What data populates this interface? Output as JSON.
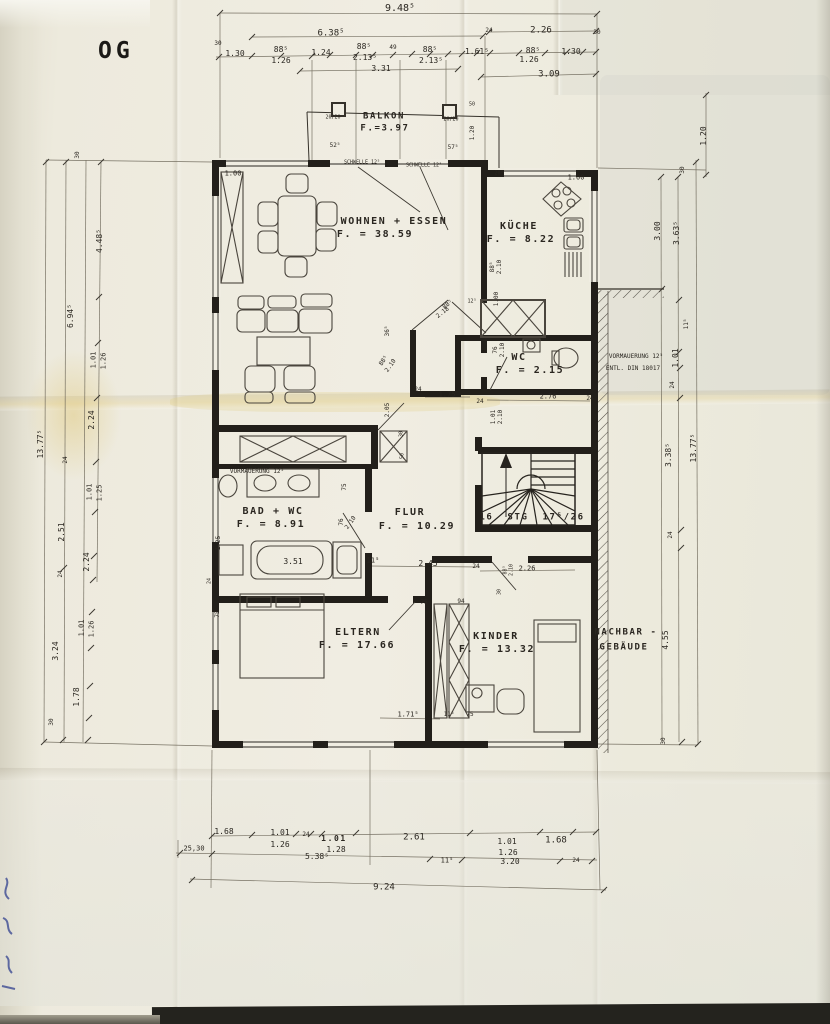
{
  "title": "OG",
  "document_type": "scanned architectural floor plan, upper storey (OG)",
  "colors": {
    "paper": "#efece1",
    "ink": "#26231d",
    "dimension_ink": "#6b6557",
    "handwriting_blue": "#32418f",
    "scan_band": "#24231e"
  },
  "rooms": [
    {
      "name": "BALKON",
      "area": "F.=3.97"
    },
    {
      "name": "WOHNEN + ESSEN",
      "area": "F. = 38.59"
    },
    {
      "name": "KÜCHE",
      "area": "F. = 8.22"
    },
    {
      "name": "WC",
      "area": "F. = 2.15"
    },
    {
      "name": "BAD + WC",
      "area": "F. = 8.91"
    },
    {
      "name": "FLUR",
      "area": "F. = 10.29"
    },
    {
      "name": "ELTERN",
      "area": "F. = 17.66"
    },
    {
      "name": "KINDER",
      "area": "F. = 13.32"
    }
  ],
  "labels": [
    {
      "t": "9.48⁵",
      "x": 400,
      "y": 9,
      "s": 10
    },
    {
      "t": "6.38⁵",
      "x": 331,
      "y": 34,
      "s": 9
    },
    {
      "t": "2.26",
      "x": 541,
      "y": 31,
      "s": 9
    },
    {
      "t": "24",
      "x": 489,
      "y": 31,
      "s": 6
    },
    {
      "t": "30",
      "x": 218,
      "y": 44,
      "s": 6
    },
    {
      "t": "30",
      "x": 597,
      "y": 33,
      "s": 6
    },
    {
      "t": "1.30",
      "x": 235,
      "y": 54,
      "s": 8
    },
    {
      "t": "88⁵",
      "x": 281,
      "y": 50,
      "s": 8
    },
    {
      "t": "1.26",
      "x": 281,
      "y": 61,
      "s": 8
    },
    {
      "t": "1.24",
      "x": 321,
      "y": 53,
      "s": 8
    },
    {
      "t": "88⁵",
      "x": 364,
      "y": 47,
      "s": 8
    },
    {
      "t": "2.13⁵",
      "x": 365,
      "y": 58,
      "s": 8
    },
    {
      "t": "49",
      "x": 393,
      "y": 48,
      "s": 6
    },
    {
      "t": "88⁵",
      "x": 430,
      "y": 50,
      "s": 8
    },
    {
      "t": "2.13⁵",
      "x": 431,
      "y": 61,
      "s": 8
    },
    {
      "t": "1.61⁵",
      "x": 477,
      "y": 52,
      "s": 8
    },
    {
      "t": "88⁵",
      "x": 533,
      "y": 51,
      "s": 8
    },
    {
      "t": "1.26",
      "x": 529,
      "y": 60,
      "s": 8
    },
    {
      "t": "1.30",
      "x": 571,
      "y": 52,
      "s": 8
    },
    {
      "t": "3.31",
      "x": 381,
      "y": 69,
      "s": 8
    },
    {
      "t": "3.09",
      "x": 549,
      "y": 75,
      "s": 9
    },
    {
      "t": "BALKON",
      "x": 384,
      "y": 117,
      "s": 9,
      "b": 1,
      "n": "room-label-balkon"
    },
    {
      "t": "F.=3.97",
      "x": 385,
      "y": 129,
      "s": 9,
      "b": 1,
      "n": "room-area-balkon"
    },
    {
      "t": "20/20",
      "x": 333,
      "y": 118,
      "s": 5
    },
    {
      "t": "20/20",
      "x": 451,
      "y": 120,
      "s": 5
    },
    {
      "t": "50",
      "x": 472,
      "y": 105,
      "s": 5
    },
    {
      "t": "1.20",
      "x": 473,
      "y": 133,
      "r": -90,
      "s": 6
    },
    {
      "t": "52⁵",
      "x": 335,
      "y": 146,
      "s": 6
    },
    {
      "t": "57⁵",
      "x": 453,
      "y": 148,
      "s": 6
    },
    {
      "t": "SCHWELLE 12⁵",
      "x": 362,
      "y": 163,
      "s": 5,
      "n": "threshold-note"
    },
    {
      "t": "SCHWELLE 12⁵",
      "x": 424,
      "y": 166,
      "s": 5,
      "n": "threshold-note"
    },
    {
      "t": "1.00",
      "x": 233,
      "y": 174,
      "s": 7
    },
    {
      "t": "1.00",
      "x": 576,
      "y": 178,
      "s": 7
    },
    {
      "t": "20⁵",
      "x": 499,
      "y": 174,
      "s": 5
    },
    {
      "t": "WOHNEN + ESSEN",
      "x": 394,
      "y": 222,
      "s": 10,
      "b": 1,
      "n": "room-label-wohnen-essen"
    },
    {
      "t": "F. = 38.59",
      "x": 375,
      "y": 235,
      "s": 10,
      "b": 1,
      "n": "room-area-wohnen-essen"
    },
    {
      "t": "KÜCHE",
      "x": 519,
      "y": 227,
      "s": 10,
      "b": 1,
      "n": "room-label-kueche"
    },
    {
      "t": "F. = 8.22",
      "x": 521,
      "y": 240,
      "s": 10,
      "b": 1,
      "n": "room-area-kueche"
    },
    {
      "t": "88⁵",
      "x": 493,
      "y": 267,
      "r": -90,
      "s": 6
    },
    {
      "t": "2.10",
      "x": 500,
      "y": 267,
      "r": -90,
      "s": 6
    },
    {
      "t": "1.00",
      "x": 497,
      "y": 299,
      "r": -90,
      "s": 6
    },
    {
      "t": "12⁵",
      "x": 472,
      "y": 302,
      "s": 5
    },
    {
      "t": "88⁵",
      "x": 448,
      "y": 305,
      "r": -38,
      "s": 6
    },
    {
      "t": "2.18",
      "x": 443,
      "y": 313,
      "r": -38,
      "s": 6
    },
    {
      "t": "WC",
      "x": 519,
      "y": 358,
      "s": 10,
      "b": 1,
      "n": "room-label-wc"
    },
    {
      "t": "F. = 2.15",
      "x": 530,
      "y": 371,
      "s": 10,
      "b": 1,
      "n": "room-area-wc"
    },
    {
      "t": "76",
      "x": 496,
      "y": 350,
      "r": -90,
      "s": 6
    },
    {
      "t": "2.10",
      "x": 503,
      "y": 350,
      "r": -90,
      "s": 6
    },
    {
      "t": "VORMAUERUNG 12⁵",
      "x": 636,
      "y": 357,
      "s": 6,
      "n": "note-vormauerung"
    },
    {
      "t": "ENTL. DIN 18017",
      "x": 633,
      "y": 369,
      "s": 6,
      "n": "note-din"
    },
    {
      "t": "2.76",
      "x": 548,
      "y": 397,
      "s": 7
    },
    {
      "t": "24",
      "x": 590,
      "y": 399,
      "s": 6
    },
    {
      "t": "24",
      "x": 480,
      "y": 402,
      "s": 6
    },
    {
      "t": "1.01",
      "x": 494,
      "y": 417,
      "r": -90,
      "s": 6
    },
    {
      "t": "2.10",
      "x": 501,
      "y": 417,
      "r": -90,
      "s": 6
    },
    {
      "t": "36⁵",
      "x": 388,
      "y": 331,
      "r": -90,
      "s": 6
    },
    {
      "t": "88⁵",
      "x": 384,
      "y": 361,
      "r": -55,
      "s": 6
    },
    {
      "t": "2.10",
      "x": 391,
      "y": 366,
      "r": -55,
      "s": 6
    },
    {
      "t": "24",
      "x": 418,
      "y": 390,
      "s": 6
    },
    {
      "t": "1.75",
      "x": 447,
      "y": 395,
      "s": 7
    },
    {
      "t": "2.05",
      "x": 388,
      "y": 410,
      "r": -90,
      "s": 6
    },
    {
      "t": "30",
      "x": 402,
      "y": 434,
      "r": -90,
      "s": 5
    },
    {
      "t": "50",
      "x": 403,
      "y": 456,
      "r": -90,
      "s": 5
    },
    {
      "t": "VORMAUERUNG 12⁵",
      "x": 257,
      "y": 472,
      "s": 6,
      "n": "note-vormauerung"
    },
    {
      "t": "BAD + WC",
      "x": 273,
      "y": 512,
      "s": 10,
      "b": 1,
      "n": "room-label-bad-wc"
    },
    {
      "t": "F. = 8.91",
      "x": 271,
      "y": 525,
      "s": 10,
      "b": 1,
      "n": "room-area-bad-wc"
    },
    {
      "t": "FLUR",
      "x": 410,
      "y": 513,
      "s": 10,
      "b": 1,
      "n": "room-label-flur"
    },
    {
      "t": "F. = 10.29",
      "x": 417,
      "y": 527,
      "s": 10,
      "b": 1,
      "n": "room-area-flur"
    },
    {
      "t": "75",
      "x": 345,
      "y": 487,
      "r": -90,
      "s": 6
    },
    {
      "t": "76",
      "x": 342,
      "y": 522,
      "r": -90,
      "s": 6
    },
    {
      "t": "2.10",
      "x": 351,
      "y": 523,
      "r": -55,
      "s": 6
    },
    {
      "t": "1.25",
      "x": 219,
      "y": 543,
      "r": -90,
      "s": 6
    },
    {
      "t": "24",
      "x": 210,
      "y": 581,
      "r": -90,
      "s": 5
    },
    {
      "t": "3.51",
      "x": 293,
      "y": 562,
      "s": 8
    },
    {
      "t": "11⁵",
      "x": 373,
      "y": 561,
      "s": 7
    },
    {
      "t": "2.45",
      "x": 428,
      "y": 564,
      "s": 8
    },
    {
      "t": "16  STG  17⁵/26",
      "x": 532,
      "y": 518,
      "s": 9,
      "b": 1,
      "n": "stairs-note"
    },
    {
      "t": "2.26",
      "x": 527,
      "y": 569,
      "s": 7
    },
    {
      "t": "24",
      "x": 476,
      "y": 567,
      "s": 6
    },
    {
      "t": "88⁵",
      "x": 506,
      "y": 570,
      "r": -90,
      "s": 5
    },
    {
      "t": "2.10",
      "x": 512,
      "y": 570,
      "r": -90,
      "s": 5
    },
    {
      "t": "30",
      "x": 500,
      "y": 592,
      "r": -90,
      "s": 5
    },
    {
      "t": "75",
      "x": 424,
      "y": 603,
      "s": 6
    },
    {
      "t": "94",
      "x": 461,
      "y": 602,
      "s": 6
    },
    {
      "t": "75",
      "x": 218,
      "y": 614,
      "r": -90,
      "s": 6
    },
    {
      "t": "ELTERN",
      "x": 358,
      "y": 633,
      "s": 10,
      "b": 1,
      "n": "room-label-eltern"
    },
    {
      "t": "F. = 17.66",
      "x": 357,
      "y": 646,
      "s": 10,
      "b": 1,
      "n": "room-area-eltern"
    },
    {
      "t": "KINDER",
      "x": 496,
      "y": 637,
      "s": 10,
      "b": 1,
      "n": "room-label-kinder"
    },
    {
      "t": "F. = 13.32",
      "x": 497,
      "y": 650,
      "s": 10,
      "b": 1,
      "n": "room-area-kinder"
    },
    {
      "t": "NACHBAR -",
      "x": 626,
      "y": 633,
      "s": 9,
      "b": 1,
      "n": "neighbor-building-label"
    },
    {
      "t": "GEBÄUDE",
      "x": 624,
      "y": 648,
      "s": 9,
      "b": 1,
      "n": "neighbor-building-label"
    },
    {
      "t": "1.71⁵",
      "x": 408,
      "y": 715,
      "s": 7
    },
    {
      "t": "11⁵",
      "x": 449,
      "y": 715,
      "s": 6
    },
    {
      "t": "75",
      "x": 470,
      "y": 715,
      "s": 6
    },
    {
      "t": "1.20",
      "x": 704,
      "y": 136,
      "r": -90,
      "s": 8
    },
    {
      "t": "30",
      "x": 683,
      "y": 170,
      "r": -90,
      "s": 6
    },
    {
      "t": "3.00",
      "x": 658,
      "y": 231,
      "r": -90,
      "s": 8
    },
    {
      "t": "3.63⁵",
      "x": 677,
      "y": 233,
      "r": -90,
      "s": 8
    },
    {
      "t": "11⁵",
      "x": 687,
      "y": 324,
      "r": -90,
      "s": 6
    },
    {
      "t": "1.01",
      "x": 676,
      "y": 358,
      "r": -90,
      "s": 8
    },
    {
      "t": "24",
      "x": 673,
      "y": 385,
      "r": -90,
      "s": 6
    },
    {
      "t": "3.38⁵",
      "x": 669,
      "y": 455,
      "r": -90,
      "s": 8
    },
    {
      "t": "13.77⁵",
      "x": 694,
      "y": 448,
      "r": -90,
      "s": 8
    },
    {
      "t": "24",
      "x": 671,
      "y": 535,
      "r": -90,
      "s": 6
    },
    {
      "t": "4.55",
      "x": 666,
      "y": 640,
      "r": -90,
      "s": 8
    },
    {
      "t": "30",
      "x": 664,
      "y": 741,
      "r": -90,
      "s": 6
    },
    {
      "t": "30",
      "x": 78,
      "y": 155,
      "r": -90,
      "s": 6
    },
    {
      "t": "4.48⁵",
      "x": 100,
      "y": 241,
      "r": -90,
      "s": 8
    },
    {
      "t": "6.94⁵",
      "x": 71,
      "y": 316,
      "r": -90,
      "s": 8
    },
    {
      "t": "1.01",
      "x": 94,
      "y": 360,
      "r": -90,
      "s": 7
    },
    {
      "t": "1.26",
      "x": 104,
      "y": 361,
      "r": -90,
      "s": 7
    },
    {
      "t": "2.24",
      "x": 92,
      "y": 420,
      "r": -90,
      "s": 8
    },
    {
      "t": "13.77⁵",
      "x": 41,
      "y": 444,
      "r": -90,
      "s": 8
    },
    {
      "t": "24",
      "x": 66,
      "y": 460,
      "r": -90,
      "s": 6
    },
    {
      "t": "1.01",
      "x": 90,
      "y": 492,
      "r": -90,
      "s": 7
    },
    {
      "t": "1.25",
      "x": 100,
      "y": 493,
      "r": -90,
      "s": 7
    },
    {
      "t": "2.51",
      "x": 62,
      "y": 532,
      "r": -90,
      "s": 8
    },
    {
      "t": "2.24",
      "x": 87,
      "y": 562,
      "r": -90,
      "s": 8
    },
    {
      "t": "24",
      "x": 61,
      "y": 574,
      "r": -90,
      "s": 6
    },
    {
      "t": "1.01",
      "x": 82,
      "y": 628,
      "r": -90,
      "s": 7
    },
    {
      "t": "1.26",
      "x": 92,
      "y": 629,
      "r": -90,
      "s": 7
    },
    {
      "t": "3.24",
      "x": 56,
      "y": 651,
      "r": -90,
      "s": 8
    },
    {
      "t": "1.78",
      "x": 77,
      "y": 697,
      "r": -90,
      "s": 8
    },
    {
      "t": "30",
      "x": 52,
      "y": 722,
      "r": -90,
      "s": 6
    },
    {
      "t": "1.68",
      "x": 224,
      "y": 832,
      "s": 8
    },
    {
      "t": "1.01",
      "x": 280,
      "y": 833,
      "s": 8
    },
    {
      "t": "1.26",
      "x": 280,
      "y": 845,
      "s": 8
    },
    {
      "t": "24",
      "x": 306,
      "y": 835,
      "s": 6
    },
    {
      "t": "1.01",
      "x": 334,
      "y": 839,
      "s": 8,
      "b": 1
    },
    {
      "t": "1.28",
      "x": 336,
      "y": 850,
      "s": 8
    },
    {
      "t": "2.61",
      "x": 414,
      "y": 838,
      "s": 9
    },
    {
      "t": "1.01",
      "x": 507,
      "y": 842,
      "s": 8
    },
    {
      "t": "1.26",
      "x": 508,
      "y": 853,
      "s": 8
    },
    {
      "t": "1.68",
      "x": 556,
      "y": 841,
      "s": 9
    },
    {
      "t": "25,30",
      "x": 194,
      "y": 849,
      "s": 7
    },
    {
      "t": "5.38⁵",
      "x": 317,
      "y": 857,
      "s": 8
    },
    {
      "t": "11⁵",
      "x": 447,
      "y": 861,
      "s": 7
    },
    {
      "t": "3.20",
      "x": 510,
      "y": 862,
      "s": 8
    },
    {
      "t": "24",
      "x": 576,
      "y": 861,
      "s": 6
    },
    {
      "t": "9.24",
      "x": 384,
      "y": 888,
      "s": 9
    }
  ]
}
